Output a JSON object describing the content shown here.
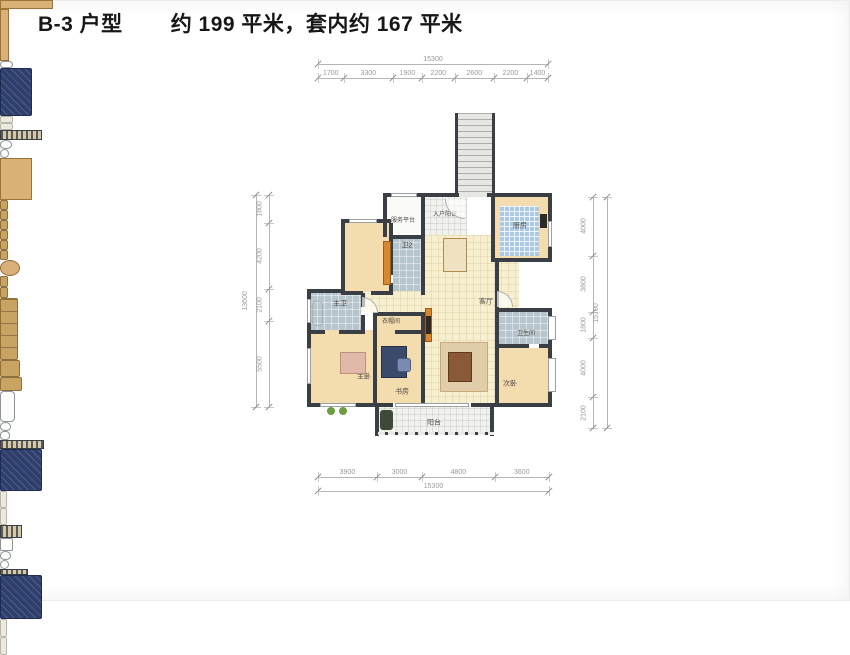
{
  "title": {
    "plan_code": "B-3 户型",
    "area_text": "约 199 平米，套内约 167 平米"
  },
  "rooms": {
    "service": {
      "label": "服务平台"
    },
    "entry": {
      "label": "入户阳台"
    },
    "kitchen": {
      "label": "厨房"
    },
    "bath2": {
      "label": "卫2"
    },
    "dining": {
      "label": "餐厅"
    },
    "living": {
      "label": "客厅"
    },
    "master_bath": {
      "label": "主卫"
    },
    "cloak": {
      "label": "衣帽间"
    },
    "master": {
      "label": "主卧"
    },
    "study": {
      "label": "书房"
    },
    "bath3": {
      "label": "卫生间"
    },
    "bed3": {
      "label": "次卧"
    },
    "balcony": {
      "label": "阳台"
    }
  },
  "dimensions": {
    "top": {
      "total": 15300,
      "segments": [
        1700,
        3300,
        1900,
        2200,
        2600,
        2200,
        1400
      ]
    },
    "bottom": {
      "total": 15300,
      "segments": [
        3900,
        3000,
        4800,
        3600
      ]
    },
    "left": {
      "total": 13600,
      "segments": [
        1800,
        4200,
        2100,
        5500
      ]
    },
    "right": {
      "total": 15700,
      "segments": [
        4000,
        3800,
        1800,
        4000,
        2100
      ]
    }
  },
  "colors": {
    "wall": "#3a3e45",
    "wood_floor": "#f3dcae",
    "hall_floor": "#f7efcd",
    "kitchen_tile": "#a9c9e6",
    "bath_tile": "#b7c5cd",
    "bed": "#2e3f6e",
    "cabinet_accent": "#d8872f",
    "dim_text": "#9a9a9a"
  }
}
